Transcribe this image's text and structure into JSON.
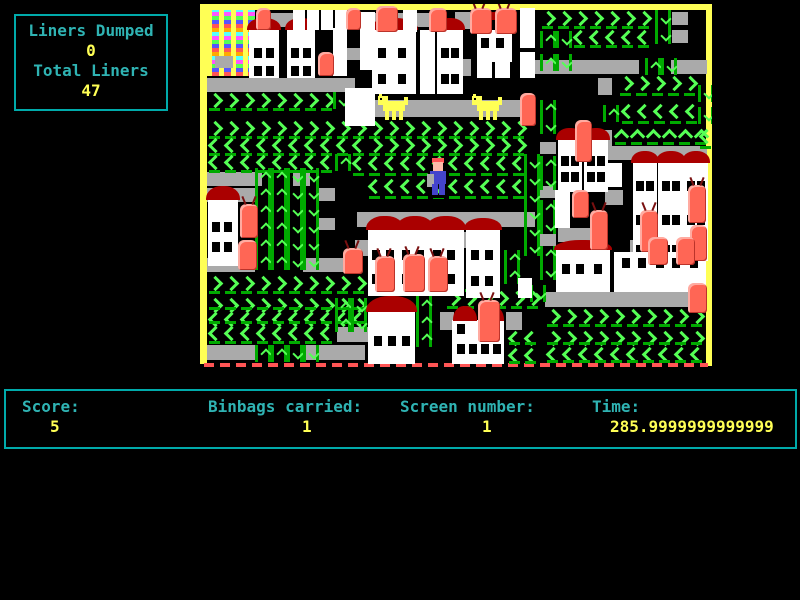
{
  "hud": {
    "liners_dumped_label": "Liners Dumped",
    "liners_dumped_value": "0",
    "total_liners_label": "Total Liners",
    "total_liners_value": "47"
  },
  "status": {
    "score_label": "Score:",
    "score_value": "5",
    "binbags_label": "Binbags carried:",
    "binbags_value": "1",
    "screen_label": "Screen number:",
    "screen_value": "1",
    "time_label": "Time:",
    "time_value": "285.9999999999999"
  },
  "palette": {
    "background": "#000000",
    "hud_border": "#00AAAA",
    "label_text": "#2FB3B3",
    "value_text": "#FFFF55",
    "wall": "#FFFF55",
    "conveyor": "#AAAAAA",
    "arrow_bright": "#55FF55",
    "arrow_dark": "#00AA00",
    "house": "#FFFFFF",
    "roof": "#AA0000",
    "binbag": "#FF6655",
    "dog": "#FFFF55",
    "player_body": "#4444CC",
    "bottom_dashes": "#FF5555"
  },
  "scene": {
    "border": {
      "top": [
        0,
        0,
        512,
        6
      ],
      "left": [
        0,
        0,
        7,
        360
      ],
      "right": [
        506,
        0,
        6,
        362
      ],
      "bottom_dash": [
        4,
        359,
        504,
        4
      ]
    },
    "rainbow": [
      7,
      6,
      48,
      66
    ],
    "conveyors": [
      [
        70,
        9,
        24,
        14
      ],
      [
        170,
        9,
        62,
        14
      ],
      [
        327,
        56,
        112,
        14
      ],
      [
        471,
        56,
        36,
        14
      ],
      [
        7,
        74,
        148,
        14
      ],
      [
        150,
        96,
        185,
        17
      ],
      [
        407,
        142,
        100,
        14
      ],
      [
        7,
        168,
        55,
        14
      ],
      [
        93,
        168,
        17,
        14
      ],
      [
        7,
        184,
        48,
        14
      ],
      [
        157,
        208,
        178,
        15
      ],
      [
        358,
        224,
        50,
        14
      ],
      [
        430,
        236,
        76,
        13
      ],
      [
        7,
        254,
        48,
        14
      ],
      [
        103,
        254,
        58,
        14
      ],
      [
        345,
        288,
        162,
        15
      ],
      [
        137,
        323,
        33,
        15
      ],
      [
        7,
        341,
        48,
        15
      ],
      [
        103,
        341,
        62,
        15
      ]
    ],
    "grays": [
      [
        15,
        52,
        18,
        12
      ],
      [
        147,
        44,
        14,
        12
      ],
      [
        472,
        8,
        16,
        13
      ],
      [
        472,
        26,
        16,
        13
      ],
      [
        255,
        8,
        15,
        17
      ],
      [
        255,
        55,
        16,
        17
      ],
      [
        340,
        138,
        16,
        12
      ],
      [
        340,
        182,
        16,
        12
      ],
      [
        340,
        230,
        16,
        12
      ],
      [
        398,
        74,
        14,
        17
      ],
      [
        398,
        126,
        14,
        17
      ],
      [
        405,
        186,
        18,
        15
      ],
      [
        119,
        214,
        16,
        12
      ],
      [
        118,
        184,
        17,
        13
      ],
      [
        155,
        236,
        13,
        16
      ],
      [
        262,
        228,
        18,
        16
      ],
      [
        240,
        308,
        14,
        18
      ],
      [
        306,
        308,
        16,
        18
      ]
    ],
    "chevrons": [
      [
        ">",
        7,
        88,
        8,
        20
      ],
      [
        ">",
        340,
        6,
        7,
        20
      ],
      [
        "<",
        372,
        25,
        5,
        20
      ],
      [
        ">",
        418,
        71,
        5,
        22
      ],
      [
        "<",
        420,
        99,
        5,
        22
      ],
      [
        "^",
        413,
        124,
        6,
        18
      ],
      [
        "<",
        498,
        124,
        1,
        22
      ],
      [
        ">",
        7,
        116,
        20,
        20
      ],
      [
        "<",
        7,
        133,
        10,
        20
      ],
      [
        ">",
        167,
        133,
        10,
        20
      ],
      [
        "<",
        7,
        150,
        8,
        20
      ],
      [
        "<",
        151,
        151,
        11,
        22
      ],
      [
        "<",
        167,
        174,
        10,
        22
      ],
      [
        ">",
        167,
        269,
        7,
        20
      ],
      [
        ">",
        7,
        271,
        10,
        20
      ],
      [
        ">",
        7,
        293,
        10,
        14
      ],
      [
        "<",
        7,
        307,
        10,
        14
      ],
      [
        "<",
        167,
        299,
        2,
        20
      ],
      [
        "<",
        7,
        321,
        8,
        20
      ],
      [
        ">",
        245,
        286,
        6,
        20
      ],
      [
        ">",
        345,
        304,
        10,
        20
      ],
      [
        ">",
        345,
        326,
        10,
        16
      ],
      [
        "<",
        345,
        342,
        10,
        18
      ],
      [
        "<",
        307,
        326,
        2,
        16
      ],
      [
        "<",
        307,
        343,
        2,
        18
      ]
    ],
    "vbars": [
      [
        455,
        6,
        "v"
      ],
      [
        455,
        23,
        "v"
      ],
      [
        340,
        27,
        "^"
      ],
      [
        356,
        27,
        "v"
      ],
      [
        340,
        50,
        "^"
      ],
      [
        356,
        50,
        "v"
      ],
      [
        445,
        54,
        "^"
      ],
      [
        461,
        54,
        "v"
      ],
      [
        403,
        101,
        "^"
      ],
      [
        498,
        81,
        "v"
      ],
      [
        498,
        103,
        "v"
      ],
      [
        133,
        88,
        "v"
      ],
      [
        135,
        150,
        "^"
      ],
      [
        340,
        96,
        "^"
      ],
      [
        340,
        113,
        "v"
      ],
      [
        340,
        152,
        "^"
      ],
      [
        340,
        169,
        "v"
      ],
      [
        340,
        196,
        "^"
      ],
      [
        340,
        213,
        "v"
      ],
      [
        340,
        242,
        "^"
      ],
      [
        340,
        259,
        "v"
      ],
      [
        324,
        150,
        "v"
      ],
      [
        324,
        167,
        "v"
      ],
      [
        324,
        184,
        "v"
      ],
      [
        324,
        201,
        "v"
      ],
      [
        324,
        218,
        "v"
      ],
      [
        324,
        235,
        "v"
      ],
      [
        55,
        164,
        "^"
      ],
      [
        71,
        164,
        "^"
      ],
      [
        87,
        164,
        "v"
      ],
      [
        103,
        164,
        "v"
      ],
      [
        55,
        181,
        "^"
      ],
      [
        71,
        181,
        "^"
      ],
      [
        87,
        181,
        "v"
      ],
      [
        103,
        181,
        "v"
      ],
      [
        55,
        198,
        "^"
      ],
      [
        71,
        198,
        "^"
      ],
      [
        87,
        198,
        "v"
      ],
      [
        103,
        198,
        "v"
      ],
      [
        55,
        215,
        "^"
      ],
      [
        71,
        215,
        "^"
      ],
      [
        87,
        215,
        "v"
      ],
      [
        103,
        215,
        "v"
      ],
      [
        55,
        232,
        "^"
      ],
      [
        71,
        232,
        "^"
      ],
      [
        87,
        232,
        "v"
      ],
      [
        103,
        232,
        "v"
      ],
      [
        55,
        249,
        "^"
      ],
      [
        71,
        249,
        "^"
      ],
      [
        87,
        249,
        "v"
      ],
      [
        103,
        249,
        "v"
      ],
      [
        55,
        341,
        "^"
      ],
      [
        71,
        341,
        "^"
      ],
      [
        87,
        341,
        "v"
      ],
      [
        103,
        341,
        "v"
      ],
      [
        135,
        294,
        "^"
      ],
      [
        151,
        294,
        "v"
      ],
      [
        135,
        311,
        "^"
      ],
      [
        151,
        311,
        "v"
      ],
      [
        216,
        292,
        "^"
      ],
      [
        216,
        309,
        "^"
      ],
      [
        216,
        326,
        "^"
      ],
      [
        304,
        246,
        "^"
      ],
      [
        304,
        263,
        "^"
      ],
      [
        330,
        281,
        "v"
      ],
      [
        268,
        269,
        "v"
      ]
    ],
    "houses": [
      [
        49,
        26,
        30,
        48,
        12,
        [
          [
            5,
            18
          ],
          [
            17,
            18
          ],
          [
            5,
            36
          ],
          [
            17,
            36
          ]
        ]
      ],
      [
        87,
        26,
        28,
        48,
        12,
        [
          [
            4,
            18
          ],
          [
            16,
            18
          ],
          [
            4,
            36
          ],
          [
            16,
            36
          ]
        ]
      ],
      [
        172,
        26,
        44,
        64,
        12,
        [
          [
            6,
            18
          ],
          [
            26,
            18
          ],
          [
            6,
            44
          ],
          [
            26,
            44
          ]
        ]
      ],
      [
        237,
        26,
        26,
        64,
        12,
        [
          [
            4,
            18
          ],
          [
            14,
            18
          ],
          [
            4,
            44
          ],
          [
            14,
            44
          ]
        ]
      ],
      [
        277,
        26,
        35,
        32,
        0,
        [
          [
            4,
            8
          ],
          [
            19,
            8
          ]
        ]
      ],
      [
        8,
        196,
        30,
        66,
        14,
        [
          [
            4,
            22
          ],
          [
            16,
            22
          ],
          [
            4,
            42
          ],
          [
            16,
            42
          ]
        ]
      ],
      [
        358,
        136,
        24,
        52,
        12,
        [
          [
            3,
            16
          ],
          [
            13,
            16
          ],
          [
            3,
            32
          ],
          [
            13,
            32
          ]
        ]
      ],
      [
        384,
        136,
        24,
        52,
        12,
        [
          [
            3,
            16
          ],
          [
            13,
            16
          ],
          [
            3,
            32
          ],
          [
            13,
            32
          ]
        ]
      ],
      [
        433,
        159,
        24,
        98,
        12,
        [
          [
            3,
            18
          ],
          [
            13,
            18
          ],
          [
            3,
            52
          ],
          [
            13,
            52
          ],
          [
            3,
            82
          ],
          [
            13,
            82
          ]
        ]
      ],
      [
        458,
        159,
        26,
        98,
        12,
        [
          [
            4,
            18
          ],
          [
            14,
            18
          ],
          [
            4,
            52
          ],
          [
            14,
            52
          ],
          [
            4,
            82
          ],
          [
            14,
            82
          ]
        ]
      ],
      [
        484,
        159,
        24,
        98,
        12,
        [
          [
            3,
            18
          ],
          [
            13,
            18
          ],
          [
            3,
            52
          ],
          [
            13,
            52
          ],
          [
            3,
            82
          ],
          [
            13,
            82
          ]
        ]
      ],
      [
        168,
        226,
        34,
        66,
        14,
        [
          [
            4,
            20
          ],
          [
            18,
            20
          ],
          [
            4,
            44
          ],
          [
            18,
            44
          ]
        ]
      ],
      [
        198,
        226,
        34,
        66,
        14,
        [
          [
            4,
            20
          ],
          [
            18,
            20
          ],
          [
            4,
            44
          ],
          [
            18,
            44
          ]
        ]
      ],
      [
        228,
        226,
        36,
        66,
        14,
        [
          [
            5,
            20
          ],
          [
            19,
            20
          ],
          [
            5,
            44
          ],
          [
            19,
            44
          ]
        ]
      ],
      [
        266,
        226,
        34,
        68,
        12,
        [
          [
            5,
            20
          ],
          [
            19,
            20
          ],
          [
            5,
            46
          ],
          [
            19,
            46
          ]
        ]
      ],
      [
        168,
        308,
        47,
        52,
        16,
        [
          [
            6,
            24
          ],
          [
            20,
            24
          ],
          [
            34,
            24
          ]
        ]
      ],
      [
        252,
        316,
        52,
        44,
        0,
        [
          [
            5,
            4
          ],
          [
            40,
            4
          ],
          [
            5,
            24
          ],
          [
            17,
            24
          ],
          [
            29,
            24
          ],
          [
            41,
            24
          ]
        ]
      ],
      [
        356,
        246,
        54,
        42,
        10,
        [
          [
            6,
            14
          ],
          [
            20,
            14
          ],
          [
            38,
            14
          ]
        ]
      ],
      [
        414,
        248,
        92,
        40,
        0,
        [
          [
            8,
            6
          ],
          [
            24,
            6
          ],
          [
            42,
            6
          ],
          [
            58,
            6
          ],
          [
            76,
            6
          ]
        ]
      ]
    ],
    "pillars": [
      [
        93,
        6,
        12,
        20
      ],
      [
        107,
        6,
        12,
        20
      ],
      [
        121,
        6,
        12,
        20
      ],
      [
        135,
        6,
        12,
        20
      ],
      [
        133,
        24,
        14,
        48
      ],
      [
        160,
        8,
        15,
        58
      ],
      [
        145,
        84,
        30,
        38
      ],
      [
        203,
        6,
        14,
        22
      ],
      [
        220,
        26,
        15,
        64
      ],
      [
        320,
        4,
        15,
        40
      ],
      [
        320,
        48,
        15,
        26
      ],
      [
        277,
        52,
        15,
        22
      ],
      [
        295,
        52,
        15,
        22
      ],
      [
        405,
        159,
        17,
        24
      ],
      [
        355,
        186,
        15,
        38
      ],
      [
        231,
        262,
        16,
        30
      ],
      [
        318,
        274,
        14,
        20
      ]
    ],
    "roofs": [
      [
        286,
        8,
        16,
        8
      ],
      [
        253,
        302,
        24,
        15
      ],
      [
        280,
        302,
        24,
        15
      ]
    ],
    "bins": [
      [
        56,
        4,
        15,
        22,
        0
      ],
      [
        146,
        4,
        15,
        22,
        0
      ],
      [
        176,
        2,
        22,
        26,
        0
      ],
      [
        229,
        4,
        18,
        24,
        0
      ],
      [
        270,
        4,
        22,
        26,
        1
      ],
      [
        295,
        4,
        22,
        26,
        1
      ],
      [
        118,
        48,
        16,
        24,
        0
      ],
      [
        320,
        89,
        16,
        33,
        0
      ],
      [
        375,
        116,
        17,
        42,
        0
      ],
      [
        40,
        200,
        18,
        34,
        1
      ],
      [
        38,
        236,
        19,
        30,
        0
      ],
      [
        372,
        186,
        17,
        28,
        0
      ],
      [
        390,
        206,
        18,
        40,
        1
      ],
      [
        440,
        206,
        18,
        42,
        1
      ],
      [
        488,
        181,
        18,
        38,
        1
      ],
      [
        490,
        221,
        17,
        36,
        0
      ],
      [
        143,
        244,
        20,
        26,
        1
      ],
      [
        175,
        252,
        20,
        36,
        1
      ],
      [
        203,
        250,
        22,
        38,
        1
      ],
      [
        228,
        252,
        20,
        36,
        1
      ],
      [
        448,
        233,
        20,
        28,
        0
      ],
      [
        476,
        233,
        19,
        28,
        0
      ],
      [
        488,
        279,
        19,
        30,
        0
      ],
      [
        278,
        296,
        22,
        42,
        1
      ]
    ],
    "dogs": [
      [
        178,
        90
      ],
      [
        272,
        90
      ]
    ],
    "player": [
      228,
      154
    ]
  }
}
